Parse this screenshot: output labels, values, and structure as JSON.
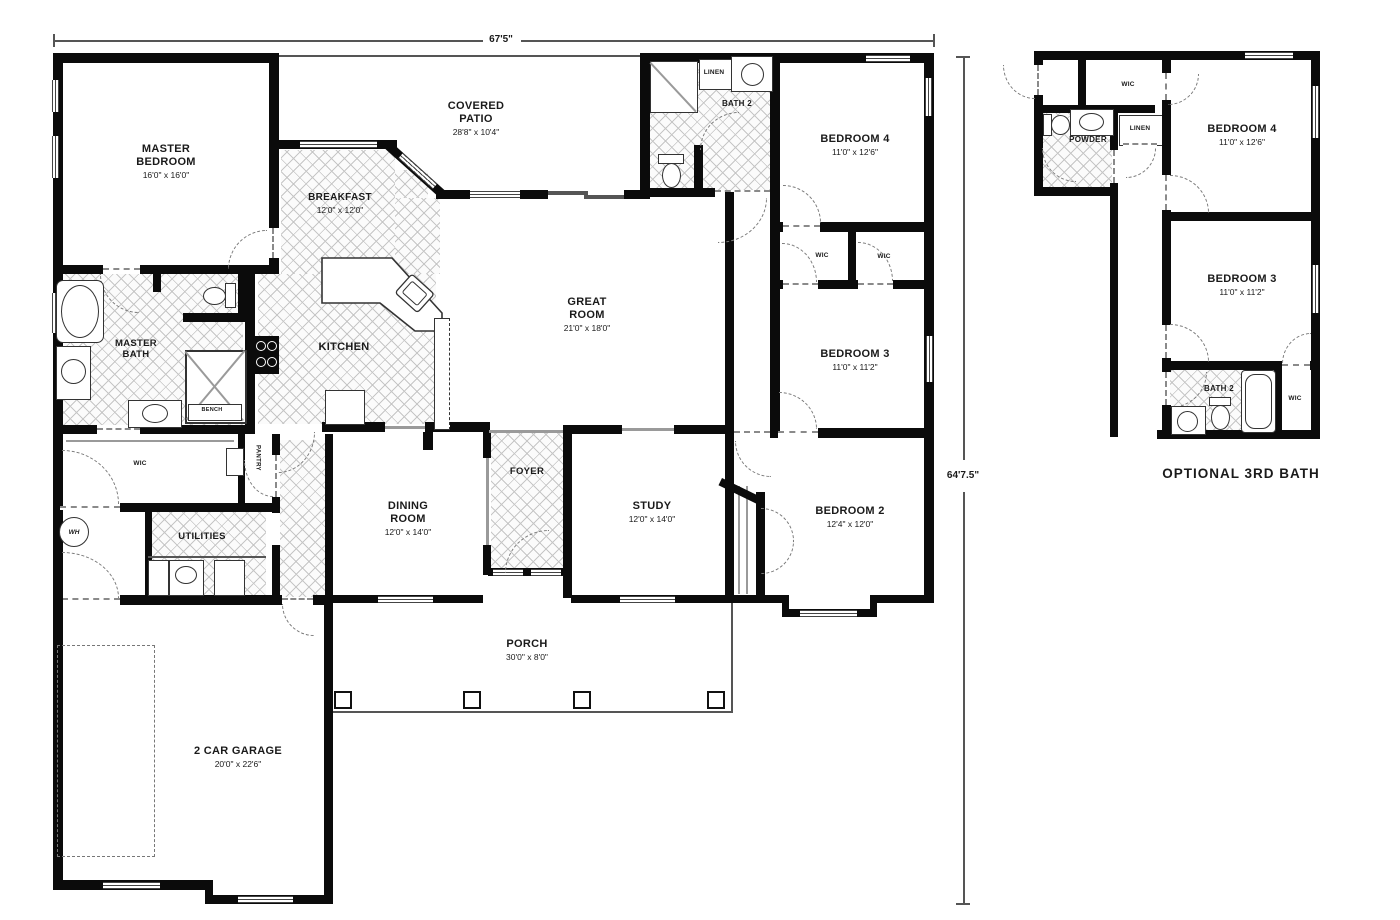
{
  "dimensions": {
    "width_label": "67'5\"",
    "height_label": "64'7.5\""
  },
  "main_plan": {
    "rooms": {
      "master_bedroom": {
        "name": "MASTER BEDROOM",
        "dims": "16'0\" x 16'0\""
      },
      "covered_patio": {
        "name": "COVERED PATIO",
        "dims": "28'8\" x 10'4\""
      },
      "breakfast": {
        "name": "BREAKFAST",
        "dims": "12'0\" x 12'0\""
      },
      "great_room": {
        "name": "GREAT ROOM",
        "dims": "21'0\" x 18'0\""
      },
      "master_bath": {
        "name": "MASTER BATH"
      },
      "kitchen": {
        "name": "KITCHEN"
      },
      "bath2": {
        "name": "BATH 2"
      },
      "linen": {
        "name": "LINEN"
      },
      "bedroom4": {
        "name": "BEDROOM 4",
        "dims": "11'0\" x 12'6\""
      },
      "bedroom3": {
        "name": "BEDROOM 3",
        "dims": "11'0\" x 11'2\""
      },
      "bedroom2": {
        "name": "BEDROOM 2",
        "dims": "12'4\" x 12'0\""
      },
      "wic_left": {
        "name": "WIC"
      },
      "wic_right": {
        "name": "WIC"
      },
      "master_wic": {
        "name": "WIC"
      },
      "pantry": {
        "name": "PANTRY"
      },
      "utilities": {
        "name": "UTILITIES"
      },
      "dining": {
        "name": "DINING ROOM",
        "dims": "12'0\" x 14'0\""
      },
      "foyer": {
        "name": "FOYER"
      },
      "study": {
        "name": "STUDY",
        "dims": "12'0\" x 14'0\""
      },
      "porch": {
        "name": "PORCH",
        "dims": "30'0\" x 8'0\""
      },
      "garage": {
        "name": "2 CAR GARAGE",
        "dims": "20'0\" x 22'6\""
      },
      "bench": {
        "name": "BENCH"
      },
      "wh": {
        "name": "WH"
      }
    }
  },
  "optional_plan": {
    "caption": "OPTIONAL 3RD BATH",
    "rooms": {
      "wic_top": {
        "name": "WIC"
      },
      "powder": {
        "name": "POWDER"
      },
      "linen": {
        "name": "LINEN"
      },
      "bedroom4": {
        "name": "BEDROOM 4",
        "dims": "11'0\" x 12'6\""
      },
      "bedroom3": {
        "name": "BEDROOM 3",
        "dims": "11'0\" x 11'2\""
      },
      "bath2": {
        "name": "BATH 2"
      },
      "wic_bath": {
        "name": "WIC"
      }
    }
  }
}
